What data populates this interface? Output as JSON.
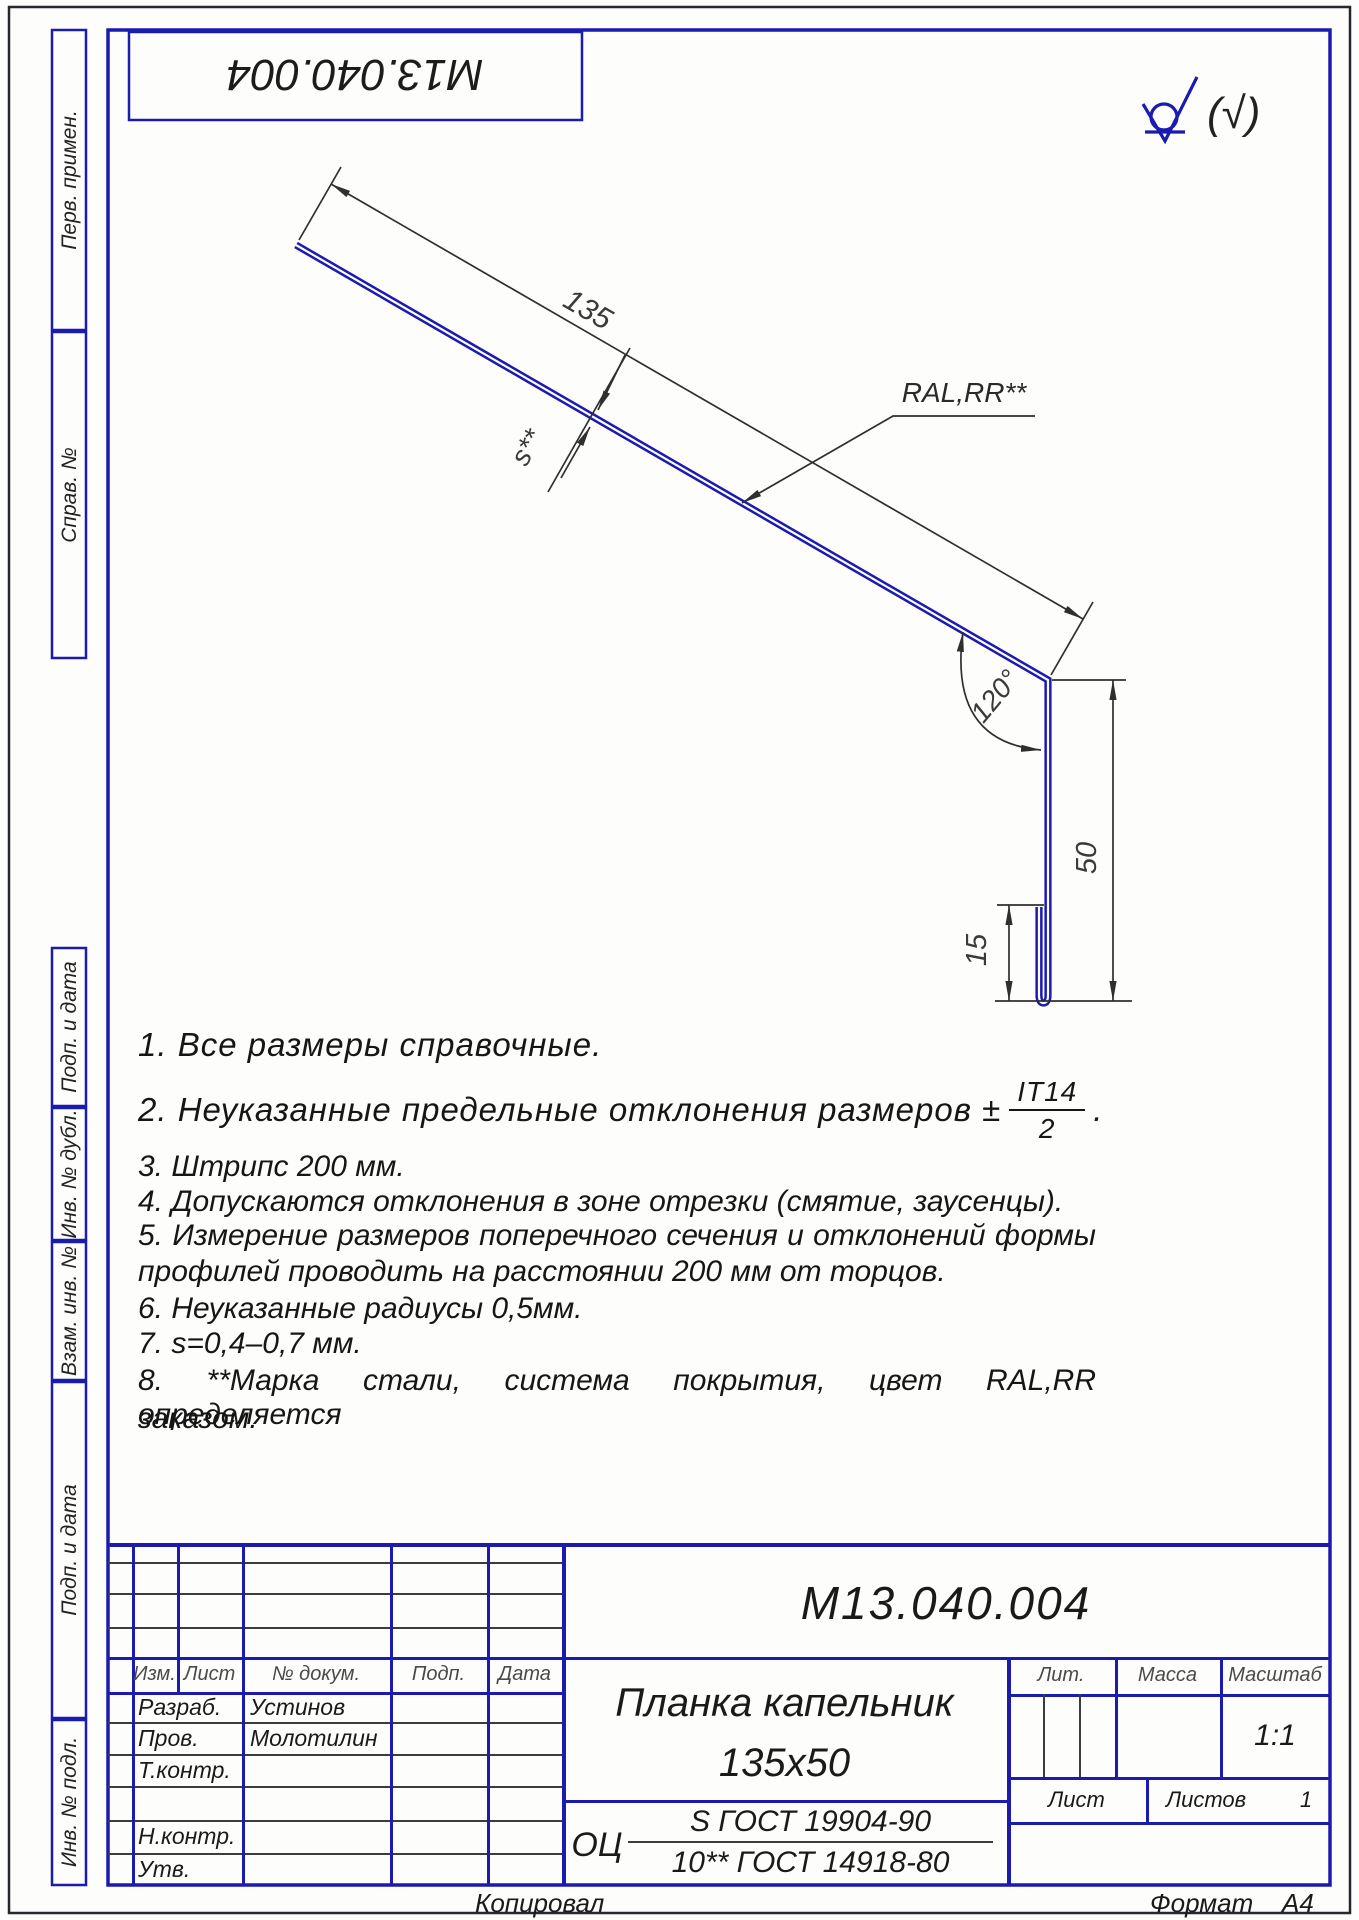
{
  "colors": {
    "blue": "#1b1bb0",
    "line": "#2f2f2f",
    "text": "#161616"
  },
  "top_stamp": "М13.040.004",
  "surface": {
    "rest_label": "(√)"
  },
  "dims": {
    "length": "135",
    "thickness": "s**",
    "coating": "RAL,RR**",
    "angle": "120°",
    "height": "50",
    "hem": "15"
  },
  "notes": {
    "n1": "1.  Все размеры справочные.",
    "n2_prefix": "2.  Неуказанные предельные отклонения размеров ±",
    "n2_frac_num": "IT14",
    "n2_frac_den": "2",
    "n2_suffix": ".",
    "n3": "3.  Штрипс 200 мм.",
    "n4": "4.  Допускаются отклонения в зоне отрезки (смятие, заусенцы).",
    "n5_line1": "5.  Измерение размеров поперечного сечения и отклонений формы",
    "n5_line2": "профилей проводить на расстоянии 200 мм от торцов.",
    "n6": "6.  Неуказанные  радиусы 0,5мм.",
    "n7": "7.  s=0,4–0,7 мм.",
    "n8_line1": "8.  **Марка стали, система покрытия, цвет RAL,RR определяется",
    "n8_line2": "заказом."
  },
  "side_labels": [
    "Перв. примен.",
    "Справ. №",
    "Подп. и дата",
    "Инв. № дубл.",
    "Взам. инв. №",
    "Подп. и дата",
    "Инв. № подл."
  ],
  "title_block": {
    "designation": "М13.040.004",
    "name_line1": "Планка капельник",
    "name_line2": "135х50",
    "material_prefix": "ОЦ",
    "material_num": "S ГОСТ 19904-90",
    "material_den": "10** ГОСТ 14918-80",
    "col_izm": "Изм.",
    "col_list": "Лист",
    "col_doc": "№ докум.",
    "col_sign": "Подп.",
    "col_date": "Дата",
    "row_razrab": "Разраб.",
    "row_razrab_name": "Устинов",
    "row_prov": "Пров.",
    "row_prov_name": "Молотилин",
    "row_tkontr": "Т.контр.",
    "row_nkontr": "Н.контр.",
    "row_utv": "Утв.",
    "lit": "Лит.",
    "massa": "Масса",
    "masshtab": "Масштаб",
    "scale": "1:1",
    "list": "Лист",
    "listov": "Листов",
    "listov_value": "1"
  },
  "footer": {
    "copied": "Копировал",
    "format_label": "Формат",
    "format_value": "А4"
  }
}
